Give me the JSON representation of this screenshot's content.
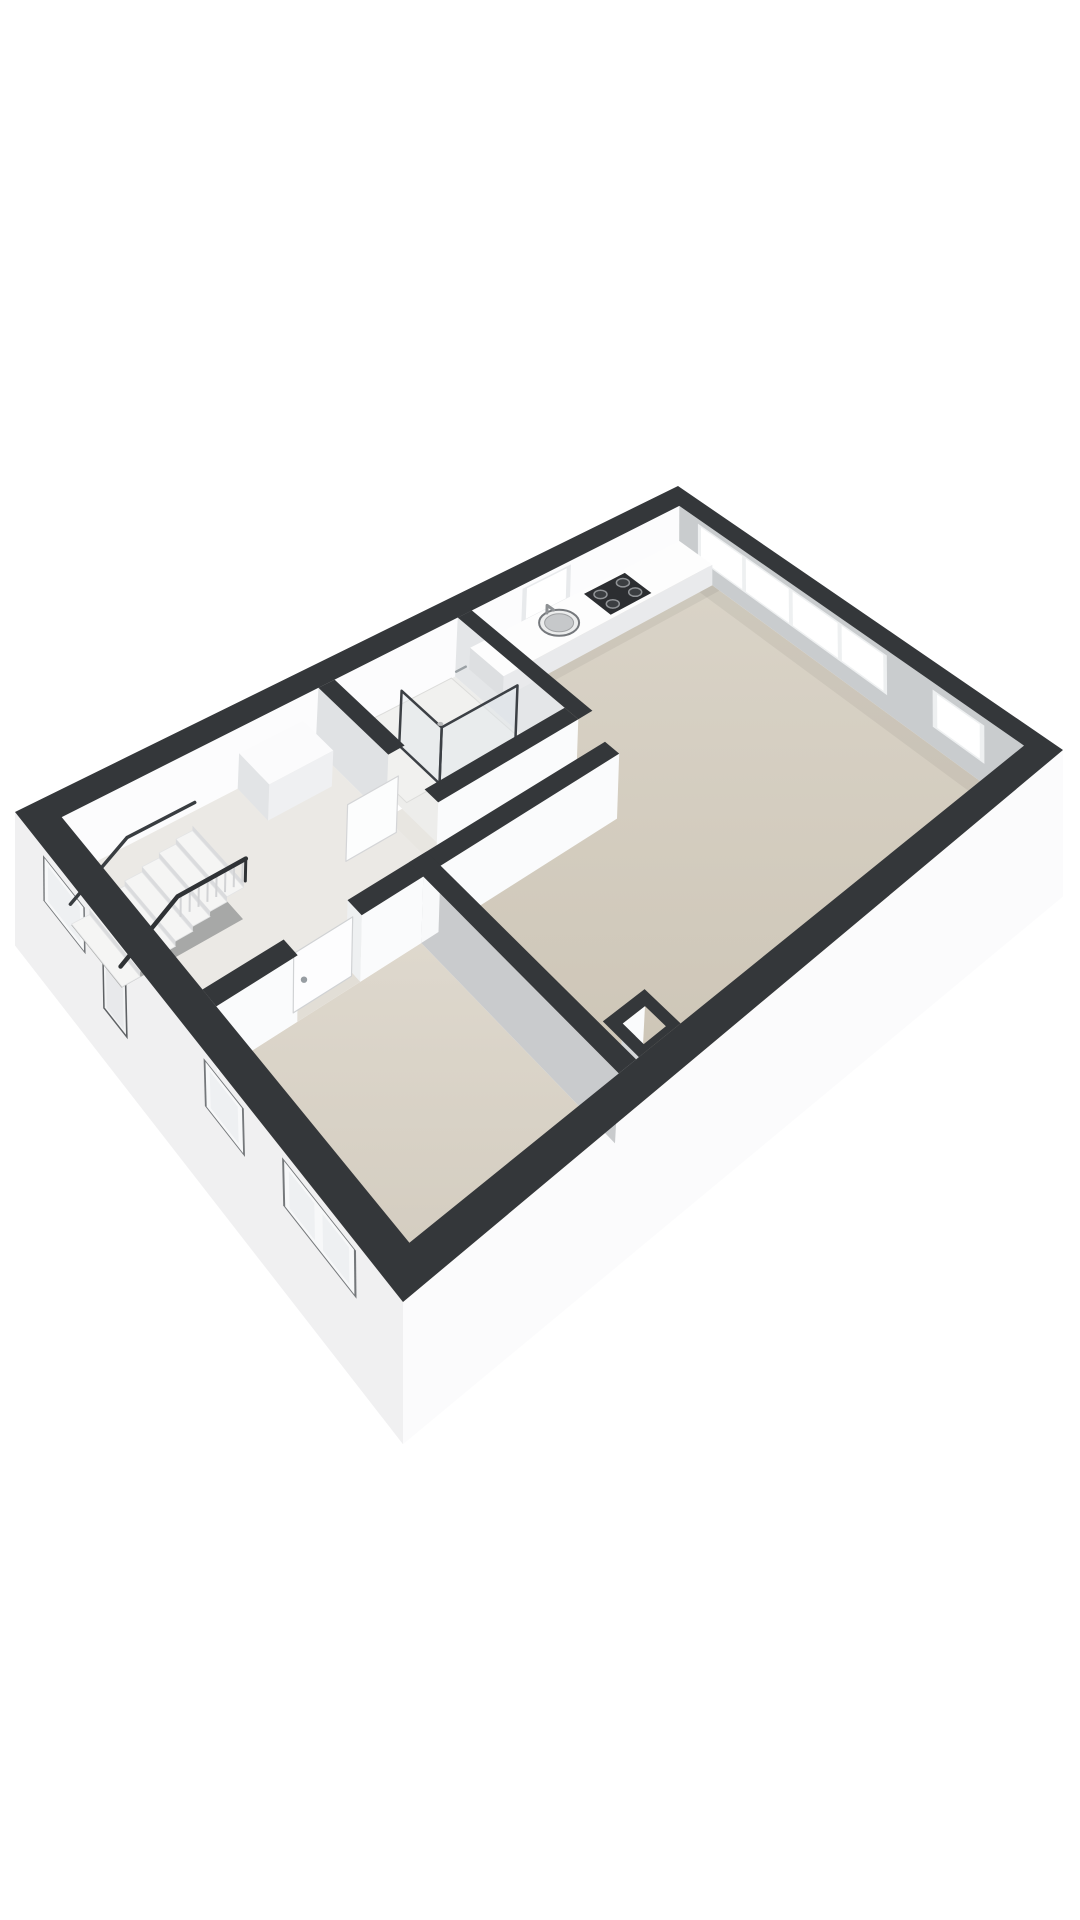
{
  "scene": {
    "width": 1080,
    "height": 1920,
    "background": "#ffffff",
    "kind": "3d-floor-plan"
  },
  "projection": {
    "plan": [
      10.5,
      6.6
    ],
    "wall_h": 2.6,
    "top_quad": [
      [
        678,
        486
      ],
      [
        15,
        812
      ],
      [
        403,
        1302
      ],
      [
        1063,
        750
      ]
    ],
    "floor_quad": [
      [
        678,
        540
      ],
      [
        15,
        874
      ],
      [
        403,
        1368
      ],
      [
        1063,
        818
      ]
    ]
  },
  "palette": {
    "wall_band": "#34373a",
    "gradients": [
      {
        "id": "gLiving",
        "from": "#dad4c8",
        "to": "#ccc4b5"
      },
      {
        "id": "gBed",
        "from": "#ded8cd",
        "to": "#d2cbbe"
      }
    ]
  },
  "features": [
    {
      "n": "nw-wall-inner-face",
      "t": "vface",
      "a": [
        0.35,
        0.35
      ],
      "b": [
        10.15,
        0.35
      ],
      "h1": 2.6,
      "h2": 0,
      "fill": "#fcfcfd"
    },
    {
      "n": "kitchen-window-frame",
      "t": "vface",
      "a": [
        2.55,
        0.35
      ],
      "b": [
        3.45,
        0.35
      ],
      "h1": 2.42,
      "h2": 0.88,
      "fill": "#e8eaec"
    },
    {
      "n": "kitchen-window-glass",
      "t": "vface",
      "a": [
        2.63,
        0.35
      ],
      "b": [
        3.37,
        0.35
      ],
      "h1": 2.34,
      "h2": 0.97,
      "fill": "#ffffff"
    },
    {
      "n": "kitchen-window-sill",
      "t": "hpoly",
      "rect": [
        2.55,
        0.35,
        3.45,
        0.52
      ],
      "h": 0.86,
      "fill": "#fafbfc"
    },
    {
      "n": "ne-wall-inner-face",
      "t": "vface",
      "a": [
        0.35,
        0.35
      ],
      "b": [
        0.35,
        6.25
      ],
      "h1": 2.6,
      "h2": 0,
      "fill": "#c9ccce"
    },
    {
      "n": "ne-window-strip-frame",
      "t": "vface",
      "a": [
        0.35,
        0.72
      ],
      "b": [
        0.35,
        4.12
      ],
      "h1": 2.38,
      "h2": 0.74,
      "fill": "#eef0f1"
    },
    {
      "n": "ne-window-strip-pane",
      "t": "vface",
      "a": [
        0.35,
        0.78
      ],
      "b": [
        0.35,
        1.57
      ],
      "h1": 2.3,
      "h2": 0.82,
      "fill": "#ffffff"
    },
    {
      "n": "ne-window-strip-pane",
      "t": "vface",
      "a": [
        0.35,
        1.64
      ],
      "b": [
        0.35,
        2.43
      ],
      "h1": 2.3,
      "h2": 0.82,
      "fill": "#ffffff"
    },
    {
      "n": "ne-window-strip-pane",
      "t": "vface",
      "a": [
        0.35,
        2.5
      ],
      "b": [
        0.35,
        3.29
      ],
      "h1": 2.3,
      "h2": 0.82,
      "fill": "#ffffff"
    },
    {
      "n": "ne-window-strip-pane",
      "t": "vface",
      "a": [
        0.35,
        3.36
      ],
      "b": [
        0.35,
        4.06
      ],
      "h1": 2.3,
      "h2": 0.82,
      "fill": "#ffffff"
    },
    {
      "n": "ne-window-single-frame",
      "t": "vface",
      "a": [
        0.35,
        4.86
      ],
      "b": [
        0.35,
        5.66
      ],
      "h1": 2.3,
      "h2": 0.8,
      "fill": "#eef0f1"
    },
    {
      "n": "ne-window-single-glass",
      "t": "vface",
      "a": [
        0.35,
        4.93
      ],
      "b": [
        0.35,
        5.59
      ],
      "h1": 2.22,
      "h2": 0.88,
      "fill": "#ffffff"
    },
    {
      "n": "living-room-floor",
      "t": "hpoly",
      "pts": [
        [
          0.35,
          0.35
        ],
        [
          4.35,
          0.35
        ],
        [
          4.35,
          2.48
        ],
        [
          6.79,
          2.48
        ],
        [
          6.79,
          3.06
        ],
        [
          7.34,
          3.06
        ],
        [
          7.34,
          6.25
        ],
        [
          0.35,
          6.25
        ]
      ],
      "h": 0,
      "fill": "url(#gLiving)"
    },
    {
      "n": "hall-floor",
      "t": "hpoly",
      "rect": [
        6.79,
        0.35,
        10.15,
        3.06
      ],
      "h": 0,
      "fill": "#ebe9e5"
    },
    {
      "n": "bedroom-floor",
      "t": "hpoly",
      "rect": [
        7.58,
        3.3,
        10.15,
        6.25
      ],
      "h": 0,
      "fill": "url(#gBed)"
    },
    {
      "n": "bathroom-floor",
      "t": "hpoly",
      "rect": [
        4.59,
        0.35,
        6.55,
        2.36
      ],
      "h": 0,
      "fill": "#ededeb"
    },
    {
      "n": "shower-tray",
      "t": "hpoly",
      "rect": [
        4.65,
        0.35,
        6.45,
        1.66
      ],
      "h": 0.01,
      "fill": "#f1f1ef",
      "stroke": "#dcdcda",
      "sw": 1
    },
    {
      "n": "doorway-threshold",
      "t": "hpoly",
      "rect": [
        8.4,
        3.06,
        9.2,
        3.3
      ],
      "h": 0,
      "fill": "#e2ded6"
    },
    {
      "n": "doorway-threshold",
      "t": "hpoly",
      "rect": [
        6.55,
        1.7,
        6.79,
        2.36
      ],
      "h": 0,
      "fill": "#e8e6e1"
    },
    {
      "n": "floor-shadow",
      "t": "hpoly",
      "rect": [
        0.35,
        0.35,
        0.62,
        6.25
      ],
      "h": 0,
      "fill": "rgba(0,0,0,0.05)"
    },
    {
      "n": "floor-shadow",
      "t": "hpoly",
      "rect": [
        0.35,
        1.0,
        4.35,
        1.14
      ],
      "h": 0,
      "fill": "rgba(0,0,0,0.05)"
    },
    {
      "n": "floor-shadow",
      "t": "hpoly",
      "rect": [
        7.2,
        3.06,
        7.34,
        6.25
      ],
      "h": 0,
      "fill": "rgba(0,0,0,0.04)"
    },
    {
      "n": "floor-shadow",
      "t": "hpoly",
      "rect": [
        4.59,
        2.92,
        7.34,
        3.06
      ],
      "h": 0,
      "fill": "rgba(0,0,0,0.04)"
    },
    {
      "n": "se-wall-inner-strip",
      "t": "vface",
      "a": [
        0.35,
        6.25
      ],
      "b": [
        6.6,
        6.25
      ],
      "h1": 0.5,
      "h2": 0,
      "fill": "#f2f3f5"
    },
    {
      "n": "sw-exterior-wall-face",
      "t": "vface",
      "a": [
        10.5,
        0.0
      ],
      "b": [
        10.5,
        6.6
      ],
      "h1": 2.6,
      "h2": -3.0,
      "fill": "#f0f0f1"
    },
    {
      "n": "stair-window-recess",
      "t": "vface",
      "a": [
        10.5,
        0.6
      ],
      "b": [
        10.5,
        1.45
      ],
      "h1": 2.28,
      "h2": 0.4,
      "fill": "#75787b"
    },
    {
      "n": "stair-window-frame",
      "t": "vface",
      "a": [
        10.5,
        0.63
      ],
      "b": [
        10.5,
        1.42
      ],
      "h1": 2.22,
      "h2": 0.46,
      "fill": "#f7f8f9"
    },
    {
      "n": "stair-window-glass",
      "t": "vface",
      "a": [
        10.5,
        0.7
      ],
      "b": [
        10.5,
        1.35
      ],
      "h1": 2.06,
      "h2": 0.62,
      "fill": "#eef0f2"
    },
    {
      "n": "entry-door-recess",
      "t": "vface",
      "a": [
        10.5,
        1.78
      ],
      "b": [
        10.5,
        2.24
      ],
      "h1": 2.3,
      "h2": -0.9,
      "fill": "#5e6164"
    },
    {
      "n": "entry-door-frame",
      "t": "vface",
      "a": [
        10.5,
        1.81
      ],
      "b": [
        10.5,
        2.21
      ],
      "h1": 2.24,
      "h2": -0.8,
      "fill": "#f2f3f4"
    },
    {
      "n": "entry-door-leaf",
      "t": "vface",
      "a": [
        10.5,
        1.85
      ],
      "b": [
        10.5,
        2.17
      ],
      "h1": 2.14,
      "h2": -0.7,
      "fill": "#e8e9eb"
    },
    {
      "n": "bedroom-window-recess",
      "t": "vface",
      "a": [
        10.5,
        3.62
      ],
      "b": [
        10.5,
        4.28
      ],
      "h1": 2.28,
      "h2": 0.4,
      "fill": "#75787b"
    },
    {
      "n": "bedroom-window-frame",
      "t": "vface",
      "a": [
        10.5,
        3.65
      ],
      "b": [
        10.5,
        4.25
      ],
      "h1": 2.22,
      "h2": 0.46,
      "fill": "#f7f8f9"
    },
    {
      "n": "bedroom-window-glass",
      "t": "vface",
      "a": [
        10.5,
        3.72
      ],
      "b": [
        10.5,
        4.18
      ],
      "h1": 2.06,
      "h2": 0.62,
      "fill": "#eef0f2"
    },
    {
      "n": "bedroom-window2-recess",
      "t": "vface",
      "a": [
        10.5,
        4.88
      ],
      "b": [
        10.5,
        5.96
      ],
      "h1": 2.28,
      "h2": 0.4,
      "fill": "#75787b"
    },
    {
      "n": "bedroom-window2-frame",
      "t": "vface",
      "a": [
        10.5,
        4.91
      ],
      "b": [
        10.5,
        5.93
      ],
      "h1": 2.22,
      "h2": 0.46,
      "fill": "#f7f8f9"
    },
    {
      "n": "bedroom-window2-pane",
      "t": "vface",
      "a": [
        10.5,
        4.98
      ],
      "b": [
        10.5,
        5.36
      ],
      "h1": 2.06,
      "h2": 0.62,
      "fill": "#eef0f2"
    },
    {
      "n": "bedroom-window2-pane",
      "t": "vface",
      "a": [
        10.5,
        5.48
      ],
      "b": [
        10.5,
        5.86
      ],
      "h1": 2.06,
      "h2": 0.62,
      "fill": "#eef0f2"
    },
    {
      "n": "se-exterior-wall-face",
      "t": "vface",
      "a": [
        0.0,
        6.6
      ],
      "b": [
        10.5,
        6.6
      ],
      "h1": 2.6,
      "h2": -3.0,
      "fill": "#fbfbfc"
    },
    {
      "n": "chimney-shaft-floor",
      "t": "hpoly",
      "rect": [
        6.84,
        5.89,
        7.16,
        6.18
      ],
      "h": 0.8,
      "fill": "#d8d3c9"
    },
    {
      "n": "chimney-inner-face",
      "t": "vface",
      "a": [
        6.84,
        5.89
      ],
      "b": [
        7.16,
        5.89
      ],
      "h1": 2.6,
      "h2": 0.8,
      "fill": "#fafbfc"
    },
    {
      "n": "chimney-inner-face",
      "t": "vface",
      "a": [
        7.16,
        5.89
      ],
      "b": [
        7.16,
        6.18
      ],
      "h1": 2.6,
      "h2": 0.8,
      "fill": "#d4d6d8"
    },
    {
      "n": "partition-face-kitchen",
      "t": "vface",
      "a": [
        4.59,
        0.35
      ],
      "b": [
        4.59,
        2.36
      ],
      "h1": 2.6,
      "h2": 0,
      "fill": "#e4e6e8"
    },
    {
      "n": "bathroom-wall-face",
      "t": "vface",
      "a": [
        4.59,
        2.6
      ],
      "b": [
        6.79,
        2.6
      ],
      "h1": 2.6,
      "h2": 0,
      "fill": "#fafbfc"
    },
    {
      "n": "bathroom-wall-face",
      "t": "vface",
      "a": [
        6.79,
        0.35
      ],
      "b": [
        6.79,
        1.7
      ],
      "h1": 2.6,
      "h2": 0,
      "fill": "#e0e2e4"
    },
    {
      "n": "bathroom-door-leaf",
      "t": "vface",
      "a": [
        6.83,
        1.94
      ],
      "b": [
        7.55,
        1.94
      ],
      "h1": 2.3,
      "h2": 0,
      "fill": "#fcfdfd",
      "stroke": "#d4d5d7",
      "sw": 1.2
    },
    {
      "n": "hall-wall-face",
      "t": "vface",
      "a": [
        4.59,
        3.3
      ],
      "b": [
        8.4,
        3.3
      ],
      "h1": 2.6,
      "h2": 0,
      "fill": "#fafbfc"
    },
    {
      "n": "hall-wall-face",
      "t": "vface",
      "a": [
        9.2,
        3.3
      ],
      "b": [
        10.15,
        3.3
      ],
      "h1": 2.6,
      "h2": 0,
      "fill": "#fafbfc"
    },
    {
      "n": "doorway-jamb",
      "t": "vface",
      "a": [
        8.4,
        3.06
      ],
      "b": [
        8.4,
        3.3
      ],
      "h1": 2.6,
      "h2": 0,
      "fill": "#eef0f1"
    },
    {
      "n": "bedroom-door-leaf",
      "t": "vface",
      "a": [
        8.43,
        3.19
      ],
      "b": [
        9.17,
        3.19
      ],
      "h1": 2.32,
      "h2": 0,
      "fill": "#fdfdfe",
      "stroke": "#d0d2d4",
      "sw": 1.2
    },
    {
      "n": "bedroom-door-handle",
      "t": "ellipse",
      "c": [
        9.04,
        3.19
      ],
      "h": 1.04,
      "rx": 3.2,
      "ry": 3.2,
      "fill": "#979da2"
    },
    {
      "n": "bedroom-wall-face",
      "t": "vface",
      "a": [
        7.58,
        3.3
      ],
      "b": [
        7.58,
        6.25
      ],
      "h1": 2.6,
      "h2": 0,
      "fill": "#c9cbcd"
    },
    {
      "n": "bedroom-wall-cap",
      "t": "vface",
      "a": [
        7.34,
        3.3
      ],
      "b": [
        7.58,
        3.3
      ],
      "h1": 2.6,
      "h2": 0,
      "fill": "#f8f9fa"
    },
    {
      "n": "hall-closet-top",
      "t": "hpoly",
      "rect": [
        7.0,
        0.35,
        7.9,
        0.95
      ],
      "h": 1.5,
      "fill": "#fbfbfc"
    },
    {
      "n": "hall-closet-front",
      "t": "vface",
      "a": [
        7.0,
        0.95
      ],
      "b": [
        7.9,
        0.95
      ],
      "h1": 1.5,
      "h2": 0,
      "fill": "#eff0f2"
    },
    {
      "n": "hall-closet-side",
      "t": "vface",
      "a": [
        7.9,
        0.35
      ],
      "b": [
        7.9,
        0.95
      ],
      "h1": 1.5,
      "h2": 0,
      "fill": "#e2e4e6"
    },
    {
      "n": "kitchen-counter-front",
      "t": "vface",
      "a": [
        0.35,
        1.0
      ],
      "b": [
        4.35,
        1.0
      ],
      "h1": 0.95,
      "h2": 0,
      "fill": "#e9eaec"
    },
    {
      "n": "kitchen-counter-end",
      "t": "vface",
      "a": [
        4.35,
        0.35
      ],
      "b": [
        4.35,
        1.0
      ],
      "h1": 0.95,
      "h2": 0,
      "fill": "#dddfe1"
    },
    {
      "n": "kitchen-counter-top",
      "t": "hpoly",
      "rect": [
        0.35,
        0.35,
        4.35,
        1.0
      ],
      "h": 0.95,
      "fill": "#fdfdfd"
    },
    {
      "n": "gas-hob",
      "t": "hpoly",
      "rect": [
        1.55,
        0.42,
        2.35,
        0.94
      ],
      "h": 0.96,
      "fill": "#2c2e31"
    },
    {
      "n": "hob-burner",
      "t": "ellipse",
      "c": [
        1.73,
        0.56
      ],
      "h": 0.97,
      "rx": 6.5,
      "ry": 4.2,
      "fill": "#3b3e41",
      "stroke": "#909396",
      "sw": 1.5
    },
    {
      "n": "hob-burner",
      "t": "ellipse",
      "c": [
        2.17,
        0.56
      ],
      "h": 0.97,
      "rx": 6.5,
      "ry": 4.2,
      "fill": "#3b3e41",
      "stroke": "#909396",
      "sw": 1.5
    },
    {
      "n": "hob-burner",
      "t": "ellipse",
      "c": [
        1.73,
        0.8
      ],
      "h": 0.97,
      "rx": 6.5,
      "ry": 4.2,
      "fill": "#3b3e41",
      "stroke": "#909396",
      "sw": 1.5
    },
    {
      "n": "hob-burner",
      "t": "ellipse",
      "c": [
        2.17,
        0.8
      ],
      "h": 0.97,
      "rx": 6.5,
      "ry": 4.2,
      "fill": "#3b3e41",
      "stroke": "#909396",
      "sw": 1.5
    },
    {
      "n": "kitchen-sink",
      "t": "ellipse",
      "c": [
        3.05,
        0.66
      ],
      "h": 0.96,
      "rx": 20,
      "ry": 13,
      "fill": "#eceded",
      "stroke": "#75787c",
      "sw": 2
    },
    {
      "n": "kitchen-sink-basin",
      "t": "ellipse",
      "c": [
        3.05,
        0.66
      ],
      "h": 0.96,
      "rx": 14.5,
      "ry": 9,
      "fill": "#c6c8ca",
      "stroke": "#9fa1a3",
      "sw": 1
    },
    {
      "n": "kitchen-faucet",
      "t": "line3",
      "pts": [
        [
          3.05,
          0.42,
          0.96
        ],
        [
          3.05,
          0.42,
          1.3
        ],
        [
          3.05,
          0.55,
          1.33
        ]
      ],
      "stroke": "#8e9194",
      "w": 3
    },
    {
      "n": "shower-glass-panel",
      "t": "vface",
      "a": [
        4.73,
        1.66
      ],
      "b": [
        5.95,
        1.66
      ],
      "h1": 2.36,
      "h2": 0.03,
      "fill": "rgba(222,229,233,0.42)",
      "stroke": "#3c4045",
      "sw": 2.5
    },
    {
      "n": "shower-glass-panel",
      "t": "vface",
      "a": [
        5.95,
        0.9
      ],
      "b": [
        5.95,
        1.66
      ],
      "h1": 2.36,
      "h2": 0.03,
      "fill": "rgba(222,229,233,0.42)",
      "stroke": "#3c4045",
      "sw": 2.5
    },
    {
      "n": "shower-mixer",
      "t": "line3",
      "pts": [
        [
          4.66,
          0.62,
          1.05
        ],
        [
          4.82,
          0.62,
          1.05
        ]
      ],
      "stroke": "#9aa0a4",
      "w": 2.5
    },
    {
      "n": "shower-drain",
      "t": "ellipse",
      "c": [
        5.3,
        0.9
      ],
      "h": 0.02,
      "rx": 3,
      "ry": 2,
      "fill": "#b9babb"
    },
    {
      "n": "stairwell-opening",
      "t": "hpoly",
      "rect": [
        8.62,
        0.52,
        10.13,
        1.52
      ],
      "h": -1.5,
      "fill": "#a7a8a7"
    },
    {
      "n": 7,
      "t": "stairs",
      "u0": 8.62,
      "step": 0.215,
      "v1": 0.52,
      "v2": 1.52,
      "drop": 0.21,
      "tread_fill": "#f5f5f4",
      "riser_fill": "#dadbdd"
    },
    {
      "n": "stair-balustrade",
      "t": "fence",
      "a": [
        8.64,
        1.52
      ],
      "b": [
        9.42,
        1.52
      ],
      "h1": 0.88,
      "h2": 0.03,
      "num": 7,
      "stroke": "#d2d3d5",
      "w": 2
    },
    {
      "n": "stair-railing",
      "t": "line3",
      "pts": [
        [
          8.6,
          1.52,
          0.93
        ],
        [
          9.46,
          1.52,
          0.93
        ],
        [
          10.14,
          1.52,
          -0.62
        ]
      ],
      "stroke": "#2f3235",
      "w": 4.5
    },
    {
      "n": "stair-railing-post",
      "t": "line3",
      "pts": [
        [
          8.6,
          1.52,
          0.93
        ],
        [
          8.6,
          1.52,
          0.02
        ]
      ],
      "stroke": "#2f3235",
      "w": 3
    },
    {
      "n": "stair-railing",
      "t": "line3",
      "pts": [
        [
          8.6,
          0.52,
          0.93
        ],
        [
          9.46,
          0.52,
          0.93
        ],
        [
          10.14,
          0.52,
          -0.62
        ]
      ],
      "stroke": "#393d41",
      "w": 3.5
    },
    {
      "n": "exterior-wall-band",
      "t": "ring",
      "outer": [
        0,
        0,
        10.5,
        6.6
      ],
      "inner": [
        0.35,
        0.35,
        10.15,
        6.25
      ],
      "fill": "#34373a"
    },
    {
      "n": "partition-wall-band",
      "t": "hpoly",
      "rect": [
        4.35,
        0.35,
        4.59,
        2.6
      ],
      "h": 2.6,
      "fill": "#34373a"
    },
    {
      "n": "partition-wall-band",
      "t": "hpoly",
      "rect": [
        4.59,
        2.36,
        6.79,
        2.6
      ],
      "h": 2.6,
      "fill": "#34373a"
    },
    {
      "n": "partition-wall-band",
      "t": "hpoly",
      "rect": [
        6.55,
        0.35,
        6.79,
        1.7
      ],
      "h": 2.6,
      "fill": "#34373a"
    },
    {
      "n": "partition-wall-band",
      "t": "hpoly",
      "rect": [
        4.59,
        3.06,
        8.4,
        3.3
      ],
      "h": 2.6,
      "fill": "#34373a"
    },
    {
      "n": "partition-wall-band",
      "t": "hpoly",
      "rect": [
        9.2,
        3.06,
        10.15,
        3.3
      ],
      "h": 2.6,
      "fill": "#34373a"
    },
    {
      "n": "partition-wall-band",
      "t": "hpoly",
      "rect": [
        7.34,
        3.06,
        7.58,
        6.25
      ],
      "h": 2.6,
      "fill": "#34373a"
    },
    {
      "n": "chimney-band",
      "t": "ring",
      "outer": [
        6.7,
        5.75,
        7.3,
        6.25
      ],
      "inner": [
        6.84,
        5.89,
        7.16,
        6.18
      ],
      "fill": "#34373a"
    }
  ]
}
